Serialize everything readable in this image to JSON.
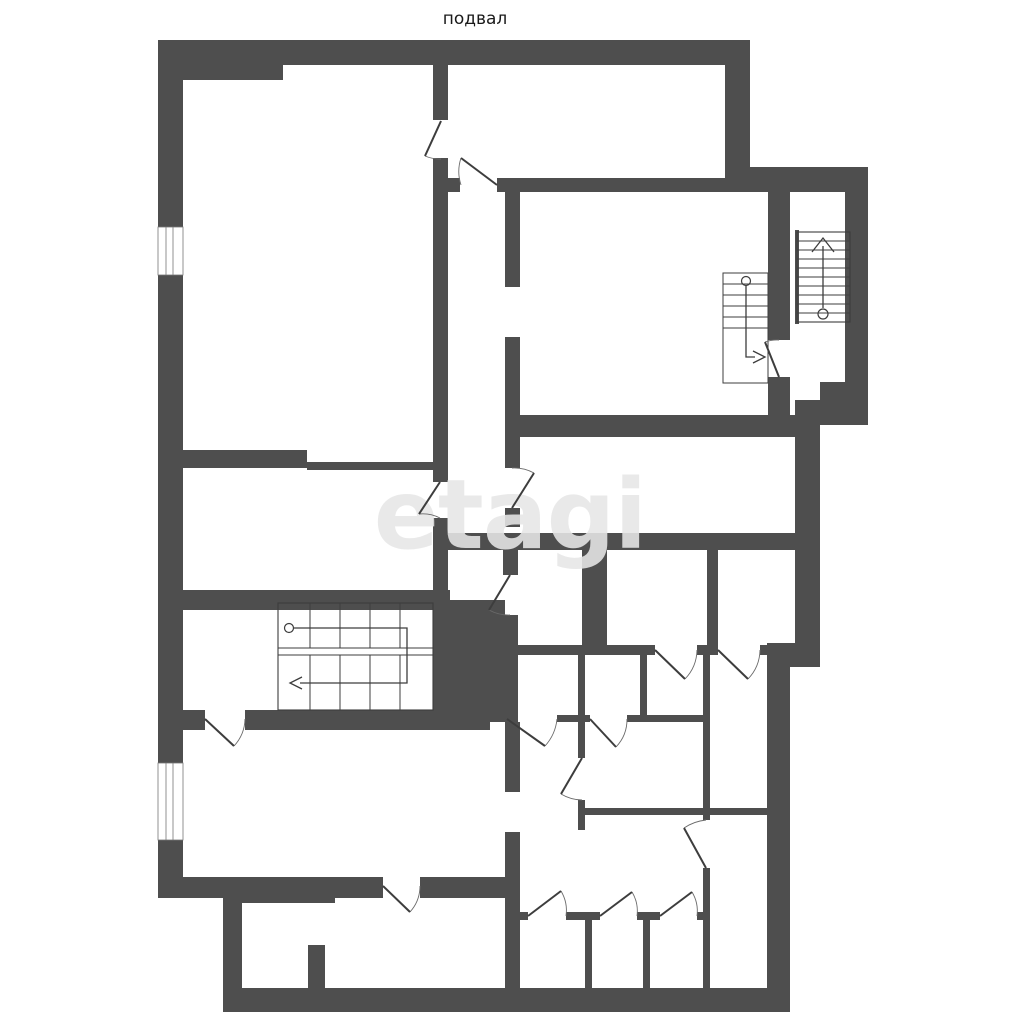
{
  "title": "подвал",
  "watermark": "etagi",
  "colors": {
    "bg": "#ffffff",
    "wall": "#4e4e4e",
    "line": "#3d3d3d",
    "arc": "#6a6a6a",
    "watermark": "#e7e7e7",
    "text": "#1a1a1a"
  },
  "plan": {
    "walls": [
      [
        158,
        40,
        592,
        25
      ],
      [
        158,
        65,
        125,
        15
      ],
      [
        158,
        65,
        25,
        162
      ],
      [
        158,
        275,
        25,
        488
      ],
      [
        158,
        840,
        25,
        58
      ],
      [
        725,
        40,
        25,
        127
      ],
      [
        725,
        167,
        143,
        25
      ],
      [
        845,
        192,
        23,
        190
      ],
      [
        820,
        382,
        48,
        43
      ],
      [
        795,
        400,
        60,
        25
      ],
      [
        795,
        415,
        25,
        252
      ],
      [
        767,
        643,
        53,
        24
      ],
      [
        767,
        655,
        23,
        357
      ],
      [
        223,
        988,
        567,
        24
      ],
      [
        223,
        892,
        19,
        120
      ],
      [
        158,
        877,
        225,
        21
      ],
      [
        420,
        877,
        100,
        21
      ],
      [
        223,
        877,
        112,
        26
      ],
      [
        505,
        877,
        15,
        111
      ],
      [
        308,
        945,
        17,
        43
      ],
      [
        433,
        65,
        15,
        55
      ],
      [
        433,
        158,
        15,
        324
      ],
      [
        433,
        518,
        15,
        82
      ],
      [
        433,
        600,
        72,
        122
      ],
      [
        448,
        178,
        12,
        14
      ],
      [
        497,
        178,
        248,
        14
      ],
      [
        505,
        180,
        15,
        107
      ],
      [
        505,
        337,
        15,
        131
      ],
      [
        505,
        508,
        15,
        19
      ],
      [
        518,
        415,
        277,
        22
      ],
      [
        768,
        167,
        22,
        173
      ],
      [
        768,
        377,
        22,
        50
      ],
      [
        448,
        533,
        372,
        17
      ],
      [
        582,
        545,
        25,
        100
      ],
      [
        707,
        545,
        11,
        100
      ],
      [
        503,
        545,
        15,
        30
      ],
      [
        503,
        615,
        15,
        107
      ],
      [
        505,
        722,
        15,
        70
      ],
      [
        505,
        832,
        15,
        45
      ],
      [
        505,
        645,
        150,
        10
      ],
      [
        697,
        645,
        21,
        10
      ],
      [
        760,
        645,
        35,
        10
      ],
      [
        578,
        655,
        7,
        103
      ],
      [
        578,
        800,
        7,
        30
      ],
      [
        640,
        655,
        7,
        67
      ],
      [
        703,
        655,
        7,
        165
      ],
      [
        703,
        868,
        7,
        120
      ],
      [
        557,
        715,
        33,
        7
      ],
      [
        627,
        715,
        83,
        7
      ],
      [
        580,
        808,
        188,
        7
      ],
      [
        505,
        912,
        23,
        8
      ],
      [
        566,
        912,
        34,
        8
      ],
      [
        637,
        912,
        23,
        8
      ],
      [
        697,
        912,
        13,
        8
      ],
      [
        585,
        920,
        7,
        68
      ],
      [
        643,
        920,
        7,
        68
      ],
      [
        158,
        450,
        149,
        18
      ],
      [
        307,
        462,
        126,
        8
      ],
      [
        158,
        590,
        292,
        20
      ],
      [
        183,
        710,
        22,
        20
      ],
      [
        245,
        710,
        245,
        20
      ],
      [
        795,
        230,
        4,
        94
      ],
      [
        849,
        230,
        4,
        94
      ]
    ],
    "windows": [
      [
        158,
        227,
        25,
        48
      ],
      [
        158,
        763,
        25,
        77
      ]
    ],
    "openings": [
      [
        505,
        287,
        15,
        50
      ],
      [
        505,
        792,
        15,
        40
      ],
      [
        308,
        905,
        25,
        40
      ]
    ],
    "doors": [
      {
        "leaf": [
          441,
          121,
          425,
          156
        ],
        "arc": "M441,159 A38,38 0 0 1 425,156"
      },
      {
        "leaf": [
          497,
          185,
          461,
          158
        ],
        "arc": "M461,185 A43,43 0 0 1 461,158"
      },
      {
        "leaf": [
          440,
          482,
          419,
          514
        ],
        "arc": "M440,518 A38,38 0 0 0 419,514"
      },
      {
        "leaf": [
          512,
          508,
          534,
          473
        ],
        "arc": "M512,468 A41,41 0 0 1 534,473"
      },
      {
        "leaf": [
          779,
          377,
          765,
          342
        ],
        "arc": "M779,340 A37,37 0 0 0 765,342"
      },
      {
        "leaf": [
          510,
          575,
          489,
          610
        ],
        "arc": "M510,615 A41,41 0 0 1 489,610"
      },
      {
        "leaf": [
          507,
          719,
          545,
          746
        ],
        "arc": "M557,719 A47,47 0 0 1 545,746"
      },
      {
        "leaf": [
          590,
          719,
          616,
          747
        ],
        "arc": "M627,719 A40,40 0 0 1 616,747"
      },
      {
        "leaf": [
          655,
          650,
          685,
          679
        ],
        "arc": "M697,650 A43,43 0 0 1 685,679"
      },
      {
        "leaf": [
          718,
          650,
          748,
          679
        ],
        "arc": "M760,650 A43,43 0 0 1 748,679"
      },
      {
        "leaf": [
          205,
          719,
          234,
          746
        ],
        "arc": "M245,719 A41,41 0 0 1 234,746"
      },
      {
        "leaf": [
          383,
          886,
          410,
          912
        ],
        "arc": "M420,886 A39,39 0 0 1 410,912"
      },
      {
        "leaf": [
          582,
          758,
          561,
          794
        ],
        "arc": "M582,800 A42,42 0 0 1 561,794"
      },
      {
        "leaf": [
          706,
          868,
          684,
          828
        ],
        "arc": "M706,820 A48,48 0 0 0 684,828"
      },
      {
        "leaf": [
          528,
          916,
          561,
          891
        ],
        "arc": "M566,916 A38,38 0 0 0 561,891"
      },
      {
        "leaf": [
          600,
          916,
          632,
          892
        ],
        "arc": "M637,916 A37,37 0 0 0 632,892"
      },
      {
        "leaf": [
          660,
          916,
          692,
          892
        ],
        "arc": "M697,916 A37,37 0 0 0 692,892"
      }
    ],
    "stairs": {
      "tower": {
        "box": [
          797,
          232,
          53,
          90
        ],
        "treads_y": [
          241,
          250,
          259,
          268,
          277,
          286,
          295,
          304,
          313
        ],
        "arrow_line": [
          823,
          246,
          823,
          308
        ],
        "arrow_head": "M812,252 L823,238 L834,252",
        "circle": [
          823,
          314,
          5
        ]
      },
      "small": {
        "box": [
          723,
          273,
          45,
          110
        ],
        "treads_y": [
          284,
          295,
          306,
          317,
          328
        ],
        "circle": [
          746,
          281,
          4.5
        ],
        "path": "M746,286 L746,357 L755,357",
        "arrow_head": "M753,351 L765,357 L753,363"
      },
      "ushape": {
        "box": [
          278,
          603,
          155,
          107
        ],
        "mid_y": [
          648,
          655
        ],
        "verticals_x": [
          310,
          340,
          370,
          400
        ],
        "circle": [
          289,
          628,
          4.5
        ],
        "path": "M294,628 L407,628 L407,683 L300,683",
        "arrow_head": "M302,677 L290,683 L302,689"
      }
    }
  }
}
